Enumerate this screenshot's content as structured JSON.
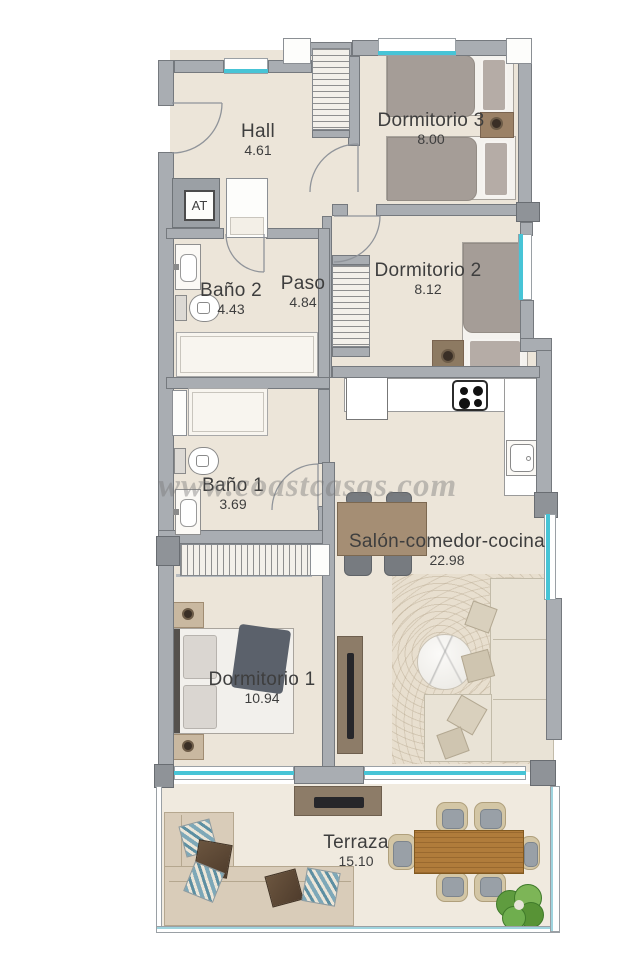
{
  "watermark": "www.coastcasas.com",
  "labels": {
    "at": "AT"
  },
  "colors": {
    "wall": "#a9adb2",
    "wall_dark": "#8f9398",
    "floor": "#ece5d9",
    "terrace_floor": "#f0eadf",
    "window_accent": "#47c4d6",
    "label_text": "#3e3e3e"
  },
  "rooms": {
    "hall": {
      "name": "Hall",
      "area": "4.61"
    },
    "dormitorio3": {
      "name": "Dormitorio 3",
      "area": "8.00"
    },
    "bano2": {
      "name": "Baño 2",
      "area": "4.43"
    },
    "paso": {
      "name": "Paso",
      "area": "4.84"
    },
    "dormitorio2": {
      "name": "Dormitorio 2",
      "area": "8.12"
    },
    "bano1": {
      "name": "Baño 1",
      "area": "3.69"
    },
    "salon": {
      "name": "Salón-comedor-cocina",
      "area": "22.98"
    },
    "dormitorio1": {
      "name": "Dormitorio 1",
      "area": "10.94"
    },
    "terraza": {
      "name": "Terraza",
      "area": "15.10"
    }
  }
}
